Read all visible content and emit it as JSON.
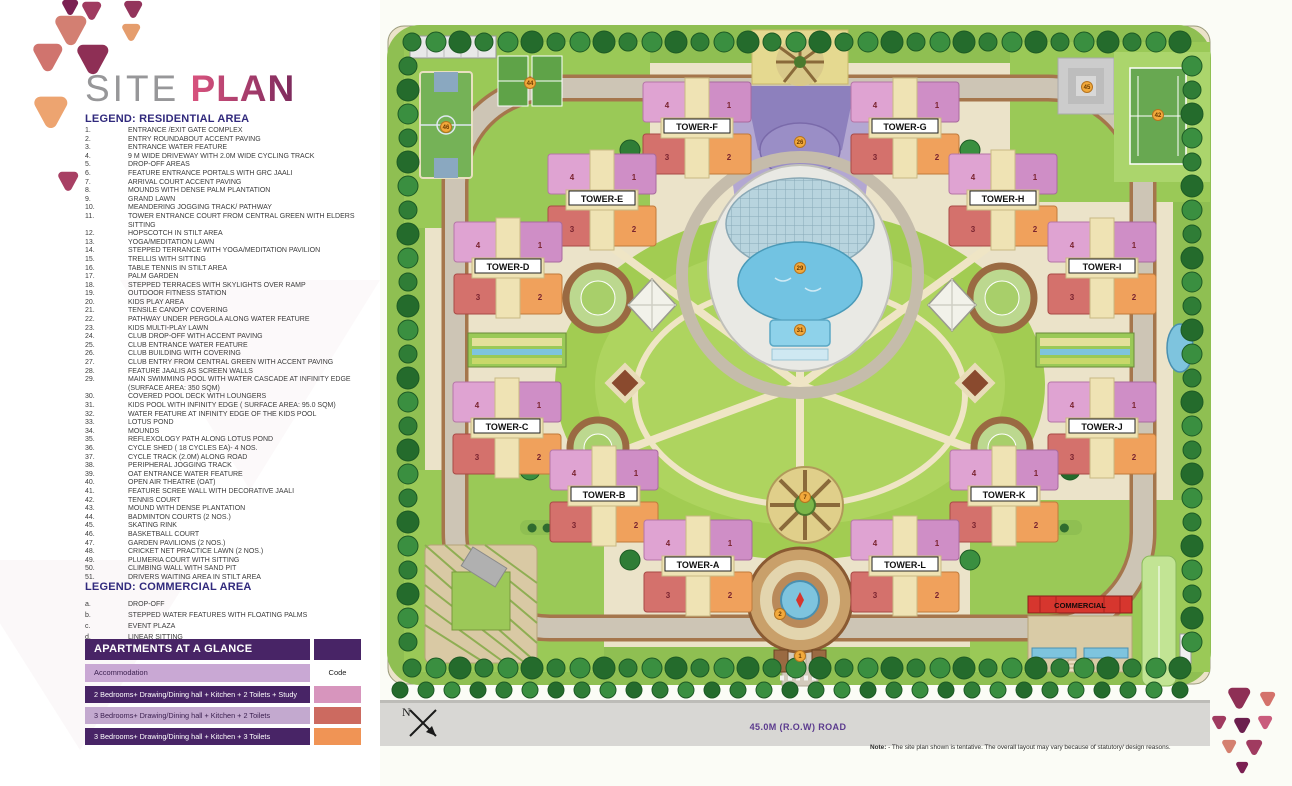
{
  "title": {
    "light": "SITE",
    "bold": "PLAN"
  },
  "legend_residential": {
    "heading": "LEGEND: RESIDENTIAL AREA",
    "items": [
      {
        "n": "1.",
        "t": "ENTRANCE /EXIT GATE COMPLEX"
      },
      {
        "n": "2.",
        "t": "ENTRY ROUNDABOUT ACCENT PAVING"
      },
      {
        "n": "3.",
        "t": "ENTRANCE WATER FEATURE"
      },
      {
        "n": "4.",
        "t": "9 M WIDE DRIVEWAY WITH 2.0M WIDE CYCLING TRACK"
      },
      {
        "n": "5.",
        "t": "DROP-OFF AREAS"
      },
      {
        "n": "6.",
        "t": "FEATURE ENTRANCE PORTALS WITH GRC JAALI"
      },
      {
        "n": "7.",
        "t": "ARRIVAL COURT ACCENT PAVING"
      },
      {
        "n": "8.",
        "t": "MOUNDS WITH DENSE PALM PLANTATION"
      },
      {
        "n": "9.",
        "t": "GRAND LAWN"
      },
      {
        "n": "10.",
        "t": "MEANDERING JOGGING TRACK/ PATHWAY"
      },
      {
        "n": "11.",
        "t": "TOWER ENTRANCE COURT FROM CENTRAL GREEN WITH ELDERS SITTING"
      },
      {
        "n": "12.",
        "t": "HOPSCOTCH IN STILT AREA"
      },
      {
        "n": "13.",
        "t": "YOGA/MEDITATION LAWN"
      },
      {
        "n": "14.",
        "t": "STEPPED TERRANCE WITH YOGA/MEDITATION PAVILION"
      },
      {
        "n": "15.",
        "t": "TRELLIS WITH SITTING"
      },
      {
        "n": "16.",
        "t": "TABLE TENNIS IN STILT AREA"
      },
      {
        "n": "17.",
        "t": "PALM GARDEN"
      },
      {
        "n": "18.",
        "t": "STEPPED TERRACES WITH SKYLIGHTS OVER RAMP"
      },
      {
        "n": "19.",
        "t": "OUTDOOR FITNESS STATION"
      },
      {
        "n": "20.",
        "t": "KIDS PLAY AREA"
      },
      {
        "n": "21.",
        "t": "TENSILE CANOPY COVERING"
      },
      {
        "n": "22.",
        "t": "PATHWAY UNDER PERGOLA ALONG WATER FEATURE"
      },
      {
        "n": "23.",
        "t": "KIDS MULTI-PLAY LAWN"
      },
      {
        "n": "24.",
        "t": "CLUB DROP-OFF WITH ACCENT PAVING"
      },
      {
        "n": "25.",
        "t": "CLUB ENTRANCE WATER FEATURE"
      },
      {
        "n": "26.",
        "t": "CLUB BUILDING WITH COVERING"
      },
      {
        "n": "27.",
        "t": "CLUB ENTRY FROM CENTRAL GREEN WITH ACCENT PAVING"
      },
      {
        "n": "28.",
        "t": "FEATURE JAALIS AS SCREEN WALLS"
      },
      {
        "n": "29.",
        "t": "MAIN SWIMMING POOL WITH WATER CASCADE AT INFINITY EDGE (SURFACE AREA: 350 SQM)"
      },
      {
        "n": "30.",
        "t": "COVERED POOL DECK WITH LOUNGERS"
      },
      {
        "n": "31.",
        "t": "KIDS POOL WITH INFINITY EDGE ( SURFACE AREA: 95.0 SQM)"
      },
      {
        "n": "32.",
        "t": "WATER FEATURE AT INFINITY EDGE OF THE KIDS POOL"
      },
      {
        "n": "33.",
        "t": "LOTUS POND"
      },
      {
        "n": "34.",
        "t": "MOUNDS"
      },
      {
        "n": "35.",
        "t": "REFLEXOLOGY PATH ALONG LOTUS POND"
      },
      {
        "n": "36.",
        "t": "CYCLE SHED ( 18 CYCLES EA)- 4 NOS."
      },
      {
        "n": "37.",
        "t": "CYCLE TRACK (2.0M) ALONG ROAD"
      },
      {
        "n": "38.",
        "t": "PERIPHERAL JOGGING TRACK"
      },
      {
        "n": "39.",
        "t": "OAT ENTRANCE WATER FEATURE"
      },
      {
        "n": "40.",
        "t": "OPEN AIR THEATRE (OAT)"
      },
      {
        "n": "41.",
        "t": "FEATURE SCREE WALL WITH DECORATIVE JAALI"
      },
      {
        "n": "42.",
        "t": "TENNIS COURT"
      },
      {
        "n": "43.",
        "t": "MOUND WITH DENSE PLANTATION"
      },
      {
        "n": "44.",
        "t": "BADMINTON COURTS (2 NOS.)"
      },
      {
        "n": "45.",
        "t": "SKATING RINK"
      },
      {
        "n": "46.",
        "t": "BASKETBALL COURT"
      },
      {
        "n": "47.",
        "t": "GARDEN PAVILIONS (2 NOS.)"
      },
      {
        "n": "48.",
        "t": "CRICKET NET PRACTICE LAWN (2 NOS.)"
      },
      {
        "n": "49.",
        "t": "PLUMERIA COURT WITH SITTING"
      },
      {
        "n": "50.",
        "t": "CLIMBING WALL WITH SAND PIT"
      },
      {
        "n": "51.",
        "t": "DRIVERS WAITING AREA IN STILT AREA"
      }
    ]
  },
  "legend_commercial": {
    "heading": "LEGEND: COMMERCIAL AREA",
    "items": [
      {
        "n": "a.",
        "t": "DROP-OFF"
      },
      {
        "n": "b.",
        "t": "STEPPED WATER FEATURES WITH FLOATING PALMS"
      },
      {
        "n": "c.",
        "t": "EVENT PLAZA"
      },
      {
        "n": "d.",
        "t": "LINEAR SITTING"
      }
    ]
  },
  "apartments_table": {
    "title": "APARTMENTS AT A GLANCE",
    "col_accommodation": "Accommodation",
    "col_code": "Code",
    "rows": [
      {
        "label": "2 Bedrooms+ Drawing/Dining hall + Kitchen + 2 Toilets + Study",
        "tone": "dark",
        "code_color": "#d795bd"
      },
      {
        "label": "3 Bedrooms+ Drawing/Dining hall + Kitchen + 2 Toilets",
        "tone": "light",
        "code_color": "#cc6a60"
      },
      {
        "label": "3 Bedrooms+ Drawing/Dining hall + Kitchen + 3 Toilets",
        "tone": "dark",
        "code_color": "#f09455"
      }
    ]
  },
  "map": {
    "banner": "All Flats are corner flats & green facing",
    "road_label": "45.0M (R.O.W) ROAD",
    "north_label": "N",
    "club_label": "CLUB",
    "commercial_label": "COMMERCIAL",
    "unit_numbers": [
      "4",
      "1",
      "3",
      "2"
    ],
    "towers": [
      {
        "name": "TOWER-F",
        "x": 317,
        "y": 128
      },
      {
        "name": "TOWER-G",
        "x": 525,
        "y": 128
      },
      {
        "name": "TOWER-E",
        "x": 222,
        "y": 200
      },
      {
        "name": "TOWER-H",
        "x": 623,
        "y": 200
      },
      {
        "name": "TOWER-D",
        "x": 128,
        "y": 268
      },
      {
        "name": "TOWER-I",
        "x": 722,
        "y": 268
      },
      {
        "name": "TOWER-C",
        "x": 127,
        "y": 428
      },
      {
        "name": "TOWER-J",
        "x": 722,
        "y": 428
      },
      {
        "name": "TOWER-B",
        "x": 224,
        "y": 496
      },
      {
        "name": "TOWER-K",
        "x": 624,
        "y": 496
      },
      {
        "name": "TOWER-A",
        "x": 318,
        "y": 566
      },
      {
        "name": "TOWER-L",
        "x": 525,
        "y": 566
      }
    ],
    "markers": [
      {
        "n": "46",
        "x": 66,
        "y": 127
      },
      {
        "n": "44",
        "x": 150,
        "y": 83
      },
      {
        "n": "45",
        "x": 707,
        "y": 87
      },
      {
        "n": "42",
        "x": 778,
        "y": 115
      },
      {
        "n": "26",
        "x": 420,
        "y": 142
      },
      {
        "n": "29",
        "x": 420,
        "y": 268
      },
      {
        "n": "31",
        "x": 420,
        "y": 330
      },
      {
        "n": "7",
        "x": 425,
        "y": 497
      },
      {
        "n": "2",
        "x": 400,
        "y": 614
      },
      {
        "n": "1",
        "x": 420,
        "y": 656
      }
    ]
  },
  "footnote": {
    "label": "Note:",
    "text": " - The site plan shown is tentative. The overall layout may vary because of statutory/ design reasons."
  },
  "logo": {
    "top_triangles": [
      {
        "x": 44,
        "y": 0,
        "s": 16,
        "c": "#7b2052"
      },
      {
        "x": 64,
        "y": 2,
        "s": 19,
        "c": "#a03b60"
      },
      {
        "x": 106,
        "y": 1,
        "s": 18,
        "c": "#93345c"
      },
      {
        "x": 37,
        "y": 16,
        "s": 31,
        "c": "#d37f72"
      },
      {
        "x": 104,
        "y": 24,
        "s": 18,
        "c": "#e59d6d"
      },
      {
        "x": 15,
        "y": 44,
        "s": 29,
        "c": "#d0746e"
      },
      {
        "x": 59,
        "y": 45,
        "s": 31,
        "c": "#8e2f55"
      },
      {
        "x": 16,
        "y": 97,
        "s": 33,
        "c": "#eda470"
      },
      {
        "x": 40,
        "y": 172,
        "s": 20,
        "c": "#a84064"
      }
    ],
    "bottom_triangles": [
      {
        "x": 30,
        "y": 2,
        "s": 22,
        "c": "#8e2f55"
      },
      {
        "x": 62,
        "y": 6,
        "s": 15,
        "c": "#d4726b"
      },
      {
        "x": 14,
        "y": 30,
        "s": 14,
        "c": "#a03b60"
      },
      {
        "x": 36,
        "y": 32,
        "s": 16,
        "c": "#6b1f4e"
      },
      {
        "x": 60,
        "y": 30,
        "s": 14,
        "c": "#c95c7c"
      },
      {
        "x": 24,
        "y": 54,
        "s": 14,
        "c": "#d4806f"
      },
      {
        "x": 48,
        "y": 54,
        "s": 16,
        "c": "#a03b60"
      },
      {
        "x": 38,
        "y": 76,
        "s": 12,
        "c": "#7b2052"
      }
    ]
  }
}
